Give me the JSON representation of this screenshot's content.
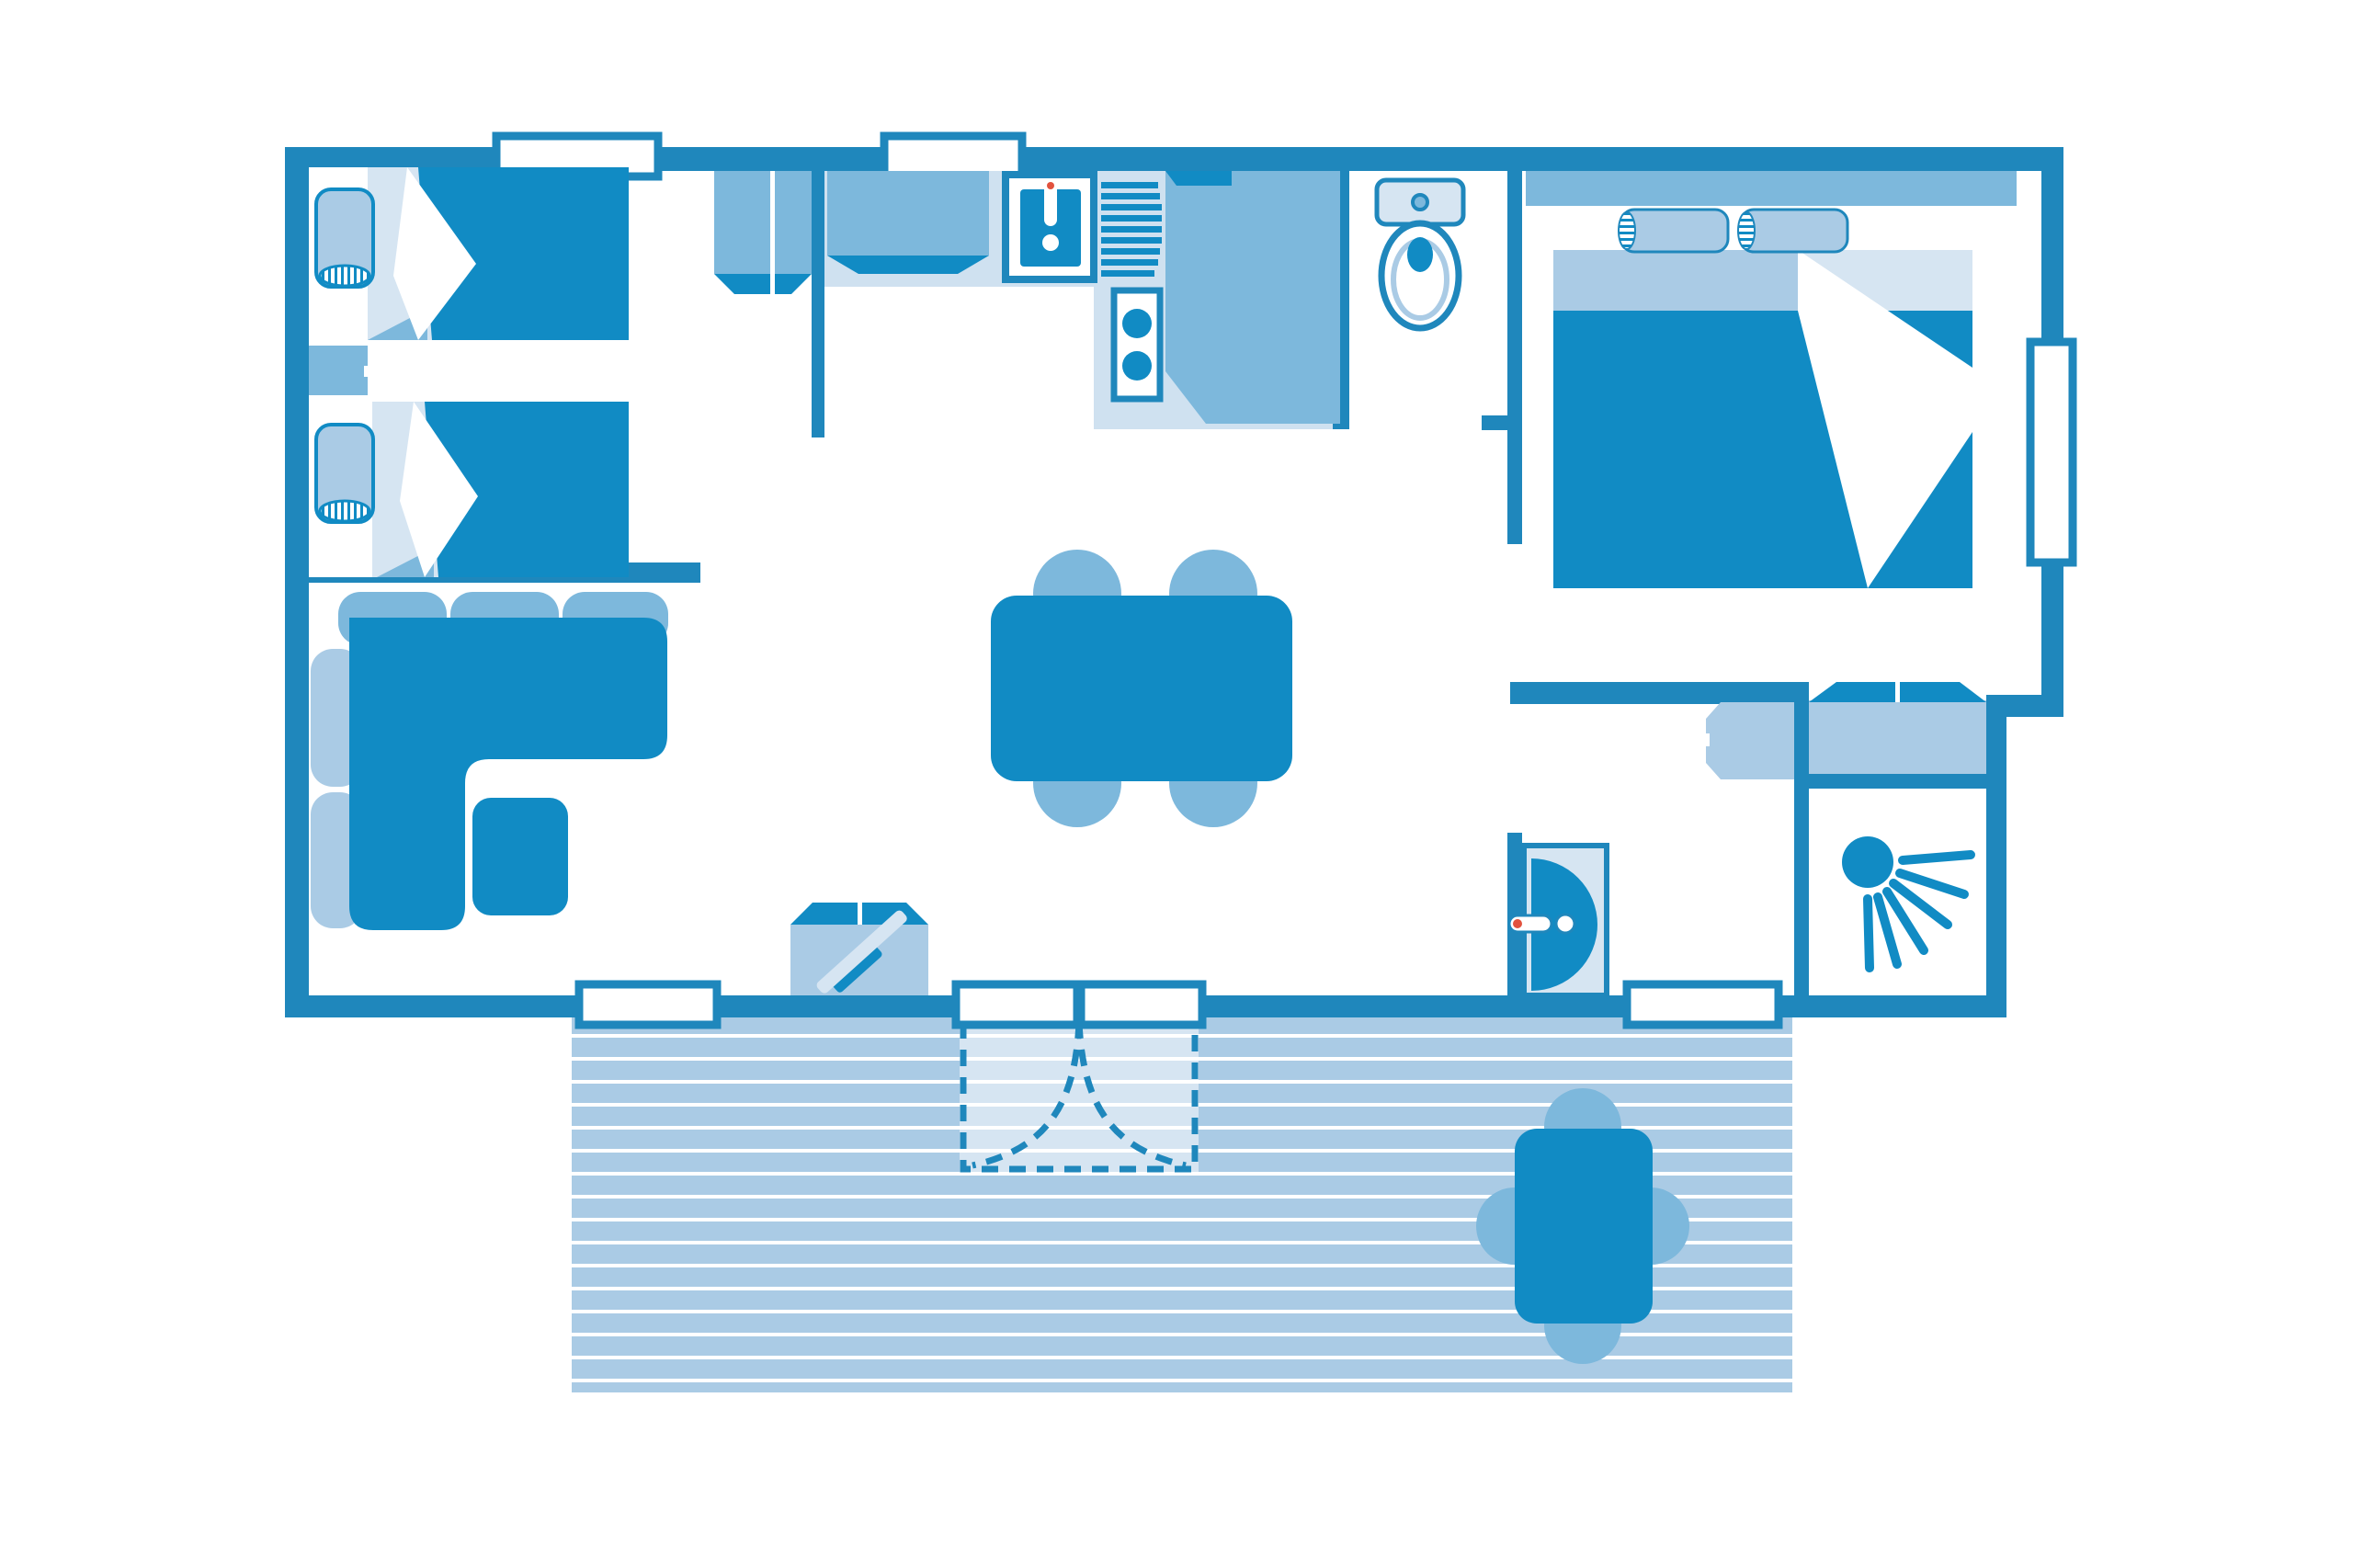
{
  "palette": {
    "wall": "#1f87bc",
    "dark": "#118bc4",
    "medium": "#7db8dc",
    "light": "#aacbe5",
    "pale": "#d6e5f2",
    "counter": "#cfe1f0",
    "accent_red": "#e2523e",
    "paper": "#ffffff"
  },
  "floorplan": {
    "kind": "mobile-home top-view floor plan, monochrome blue",
    "elements": [
      "outer-walls",
      "interior-walls",
      "window",
      "sliding-patio-door",
      "entrance-door",
      "twin-bedroom",
      "single-bed",
      "pillow",
      "nightstand",
      "closet",
      "kitchen",
      "kitchen-counter",
      "kitchen-sink",
      "faucet",
      "drainer",
      "hob-two-burners",
      "fridge-cabinet",
      "wc-room",
      "toilet",
      "master-bedroom",
      "double-bed",
      "headboard",
      "wardrobe",
      "washbasin-cabinet",
      "shower-room",
      "shower-head-icon",
      "living-room",
      "corner-sofa",
      "coffee-table",
      "tv-cabinet",
      "dining-table",
      "dining-chair",
      "deck-terrace",
      "deck-table",
      "deck-chair",
      "door-swing-dashed"
    ]
  }
}
